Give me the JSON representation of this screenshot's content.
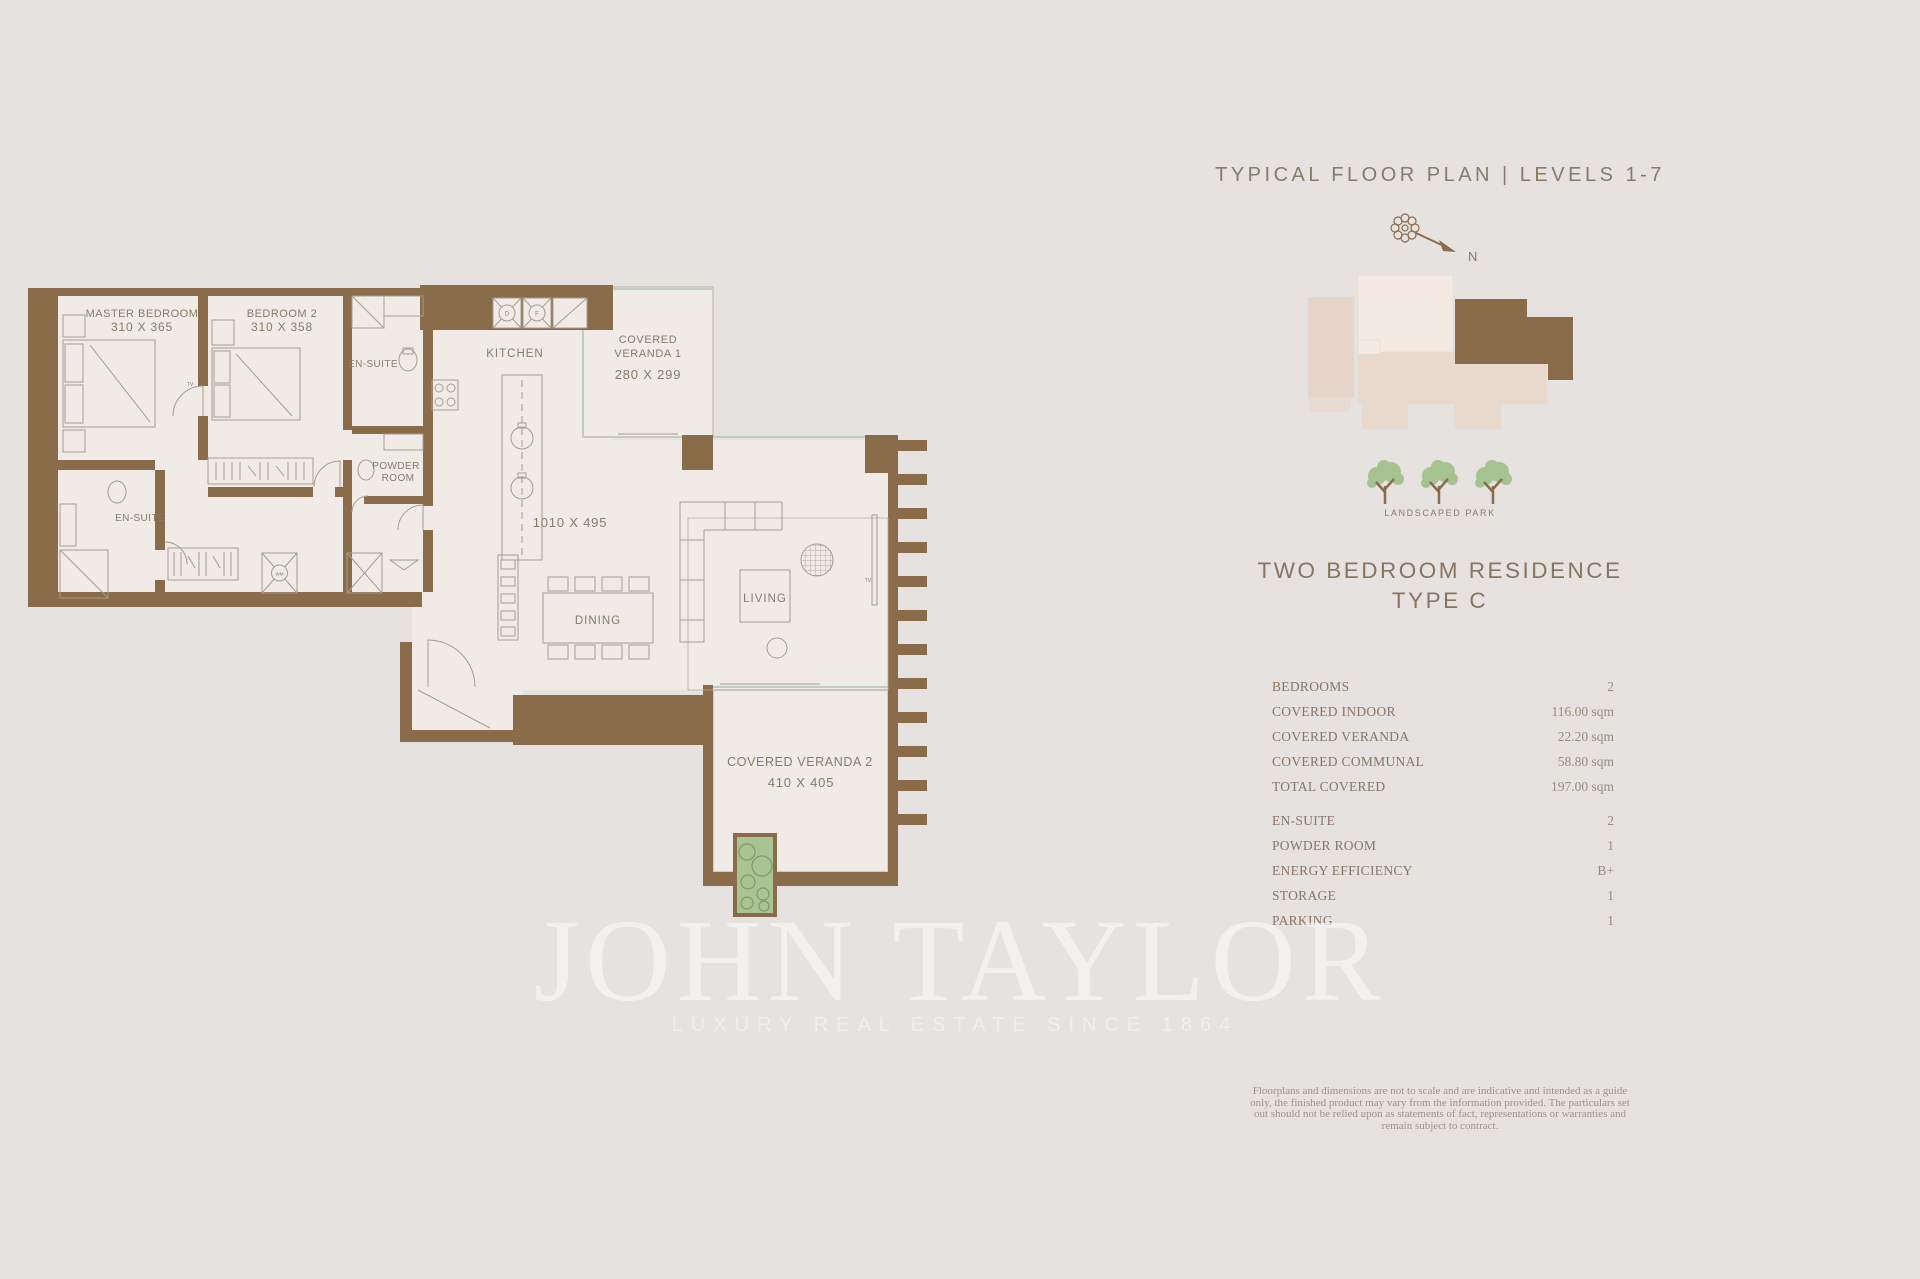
{
  "header": {
    "title": "TYPICAL FLOOR PLAN | LEVELS 1-7"
  },
  "compass": {
    "north": "N"
  },
  "key_plan": {
    "park_label": "LANDSCAPED PARK"
  },
  "residence": {
    "name": "TWO BEDROOM RESIDENCE",
    "type": "TYPE C"
  },
  "specs": {
    "rows": [
      {
        "label": "BEDROOMS",
        "value": "2"
      },
      {
        "label": "COVERED INDOOR",
        "value": "116.00 sqm"
      },
      {
        "label": "COVERED VERANDA",
        "value": "22.20 sqm"
      },
      {
        "label": "COVERED COMMUNAL",
        "value": "58.80 sqm"
      },
      {
        "label": "TOTAL COVERED",
        "value": "197.00 sqm"
      },
      {
        "label": "EN-SUITE",
        "value": "2"
      },
      {
        "label": "POWDER ROOM",
        "value": "1"
      },
      {
        "label": "ENERGY EFFICIENCY",
        "value": "B+"
      },
      {
        "label": "STORAGE",
        "value": "1"
      },
      {
        "label": "PARKING",
        "value": "1"
      }
    ]
  },
  "disclaimer": {
    "text": "Floorplans and dimensions are not to scale and are indicative and intended as a guide only, the finished product may vary from the information provided. The particulars set out should not be relied upon as statements of fact, representations or warranties and remain subject to contract."
  },
  "watermark": {
    "name": "JOHN TAYLOR",
    "tagline": "LUXURY REAL ESTATE SINCE 1864"
  },
  "plan": {
    "master_bedroom": {
      "name": "MASTER BEDROOM",
      "dim": "310 X 365"
    },
    "bedroom2": {
      "name": "BEDROOM 2",
      "dim": "310 X 358"
    },
    "ensuite1": {
      "name": "EN-SUITE"
    },
    "ensuite2": {
      "name": "EN-SUITE"
    },
    "powder_room": {
      "line1": "POWDER",
      "line2": "ROOM"
    },
    "kitchen": {
      "name": "KITCHEN"
    },
    "dining": {
      "name": "DINING"
    },
    "living": {
      "name": "LIVING"
    },
    "veranda1": {
      "line1": "COVERED",
      "line2": "VERANDA 1",
      "dim": "280 X 299"
    },
    "veranda2": {
      "name": "COVERED VERANDA 2",
      "dim": "410 X 405"
    },
    "main_dim": "1010 X 495",
    "labels": {
      "tv": "TV",
      "wm": "WM",
      "d": "D",
      "f": "F"
    }
  },
  "colors": {
    "background": "#e5e2e0",
    "wall_brown": "#8a6c4a",
    "floor": "#f0ebe6",
    "accent_text": "#8a7460",
    "keyplan_pink": "#e7d5ca",
    "keyplan_cream": "#f4eae1",
    "planter_green": "#a9c492"
  }
}
